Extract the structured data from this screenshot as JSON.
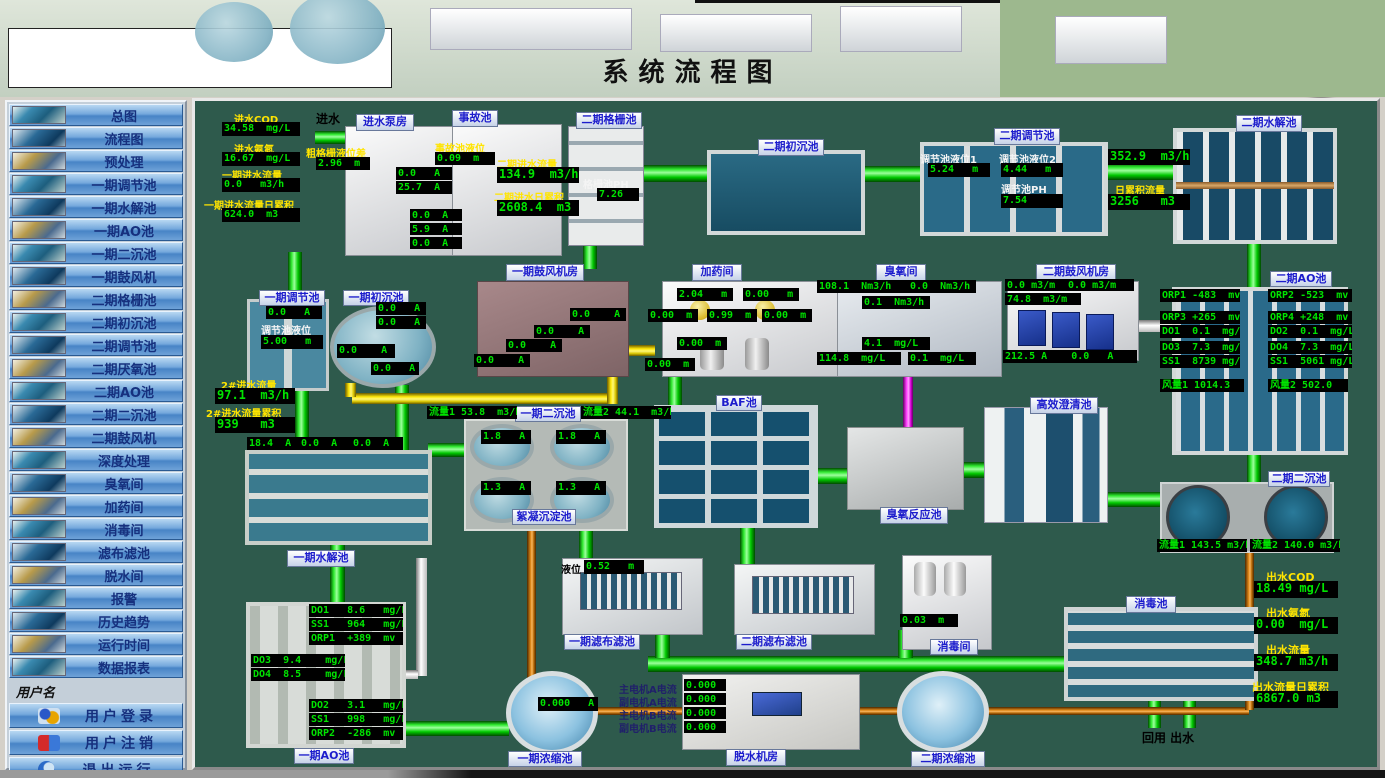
{
  "header": {
    "title": "系统流程图",
    "timestamp": "2017/11/6 9:08:59"
  },
  "sidebar": {
    "items": [
      "总图",
      "流程图",
      "预处理",
      "一期调节池",
      "一期水解池",
      "一期AO池",
      "一期二沉池",
      "一期鼓风机",
      "二期格栅池",
      "二期初沉池",
      "二期调节池",
      "二期厌氧池",
      "二期AO池",
      "二期二沉池",
      "二期鼓风机",
      "深度处理",
      "臭氧间",
      "加药间",
      "消毒间",
      "滤布滤池",
      "脱水间",
      "报警",
      "历史趋势",
      "运行时间",
      "数据报表"
    ],
    "username_label": "用户名",
    "login": "用户登录",
    "logout": "用户注销",
    "exit": "退出运行",
    "company": "山东新日电气设备有限公司"
  },
  "colors": {
    "accent_green": "#00e400",
    "label_yellow": "#ffe400",
    "panel_bg": "#2e5a4c",
    "alarm_red": "#f20000"
  },
  "main": {
    "inlet": {
      "label": "进水",
      "cod_label": "进水COD",
      "cod": "34.58  mg/L",
      "nh3_label": "进水氨氮",
      "nh3": "16.67  mg/L",
      "flow1_label": "一期进水流量",
      "flow1": "0.0   m3/h",
      "total1_label": "一期进水流量日累积",
      "total1": "624.0  m3"
    },
    "pump_house": {
      "label": "进水泵房",
      "screen_label": "粗格栅液位差",
      "screen_level": "2.96  m",
      "c1": "0.0   A",
      "c2": "25.7  A",
      "c3": "0.0  A",
      "c4": "5.9  A",
      "c5": "0.0  A"
    },
    "accident": {
      "label": "事故池",
      "level_label": "事故池液位",
      "level": "0.09  m",
      "flow2_label": "二期进水流量",
      "flow2": "134.9  m3/h",
      "total2_label": "二期进水日累积",
      "total2": "2608.4  m3"
    },
    "grid2": {
      "label": "二期格栅池",
      "ph_label": "格栅池PH",
      "ph": "7.26"
    },
    "primary2": {
      "label": "二期初沉池"
    },
    "reg2": {
      "label": "二期调节池",
      "lv1_label": "调节池液位1",
      "lv1": "5.24   m",
      "lv2_label": "调节池液位2",
      "lv2": "4.44   m",
      "ph_label": "调节池PH",
      "ph": "7.54"
    },
    "hydro2": {
      "label": "二期水解池",
      "flow": "352.9  m3/h",
      "total_label": "日累积流量",
      "total": "3256   m3"
    },
    "reg1": {
      "label": "一期调节池",
      "current": "0.0   A",
      "lv_label": "调节池液位",
      "lv": "5.00   m"
    },
    "primary1": {
      "label": "一期初沉池",
      "c1": "0.0   A",
      "c2": "0.0   A",
      "c3": "0.0    A",
      "c4": "0.0   A"
    },
    "inflow2": {
      "flow_label": "2#进水流量",
      "flow": "97.1  m3/h",
      "total_label": "2#进水流量累积",
      "total": "939   m3",
      "c1": "18.4  A",
      "c2": "0.0  A",
      "c3": "0.0  A"
    },
    "hydro1": {
      "label": "一期水解池"
    },
    "blower1": {
      "label": "一期鼓风机房",
      "c1": "0.0    A",
      "c2": "0.0    A",
      "c3": "0.0    A",
      "c4": "0.0    A"
    },
    "dosing": {
      "label": "加药间",
      "lv1": "2.04   m",
      "lv2": "0.00   m",
      "lv3": "0.00  m",
      "lv4": "0.99  m",
      "lv5": "0.00  m",
      "lv6": "0.00  m",
      "lv7": "0.00  m"
    },
    "ozone": {
      "label": "臭氧间",
      "v1": "108.1  Nm3/h",
      "v2": "0.0  Nm3/h",
      "v3": "0.1  Nm3/h",
      "v4": "4.1  mg/L",
      "v5": "114.8  mg/L",
      "v6": "0.1  mg/L"
    },
    "blower2": {
      "label": "二期鼓风机房",
      "f1": "0.0 m3/m",
      "f2": "0.0 m3/m",
      "f3": "74.8  m3/m",
      "currents": "212.5 A    0.0   A"
    },
    "ao2": {
      "label": "二期AO池",
      "rows_left": [
        "ORP1 -483  mv",
        "ORP3 +265  mv",
        "DO1  0.1  mg/L",
        "DO3  7.3  mg/L",
        "SS1  8739 mg/L",
        "风量1 1014.3"
      ],
      "rows_right": [
        "ORP2 -523  mv",
        "ORP4 +248  mv",
        "DO2  0.1  mg/L",
        "DO4  7.3  mg/L",
        "SS1  5061 mg/L",
        "风量2 502.0"
      ]
    },
    "clar1": {
      "label": "一期二沉池",
      "flow1": "流量1 53.8  m3/h",
      "flow2": "流量2 44.1  m3/h",
      "c1": "1.8   A",
      "c2": "1.8   A",
      "c3": "1.3   A",
      "c4": "1.3   A",
      "floc_label": "絮凝沉淀池"
    },
    "baf": {
      "label": "BAF池"
    },
    "ozone_tank": {
      "label": "臭氧反应池"
    },
    "clarifier_he": {
      "label": "高效澄清池"
    },
    "clar2": {
      "label": "二期二沉池",
      "flow1": "流量1 143.5 m3/h",
      "flow2": "流量2 140.0 m3/h"
    },
    "outlet": {
      "cod_label": "出水COD",
      "cod": "18.49 mg/L",
      "nh3_label": "出水氨氮",
      "nh3": "0.00  mg/L",
      "flow_label": "出水流量",
      "flow": "348.7 m3/h",
      "total_label": "出水流量日累积",
      "total": "6867.0 m3"
    },
    "disinfect_tank": {
      "label": "消毒池"
    },
    "disinfect_room": {
      "label": "消毒间",
      "level": "0.03  m"
    },
    "cloth1": {
      "label": "一期滤布滤池",
      "lv_label": "液位",
      "lv": "0.52   m"
    },
    "cloth2": {
      "label": "二期滤布滤池"
    },
    "thick1": {
      "label": "一期浓缩池",
      "current": "0.000   A"
    },
    "dewater": {
      "label": "脱水机房",
      "l1": "主电机A电流",
      "l2": "副电机A电流",
      "l3": "主电机B电流",
      "l4": "副电机B电流",
      "v1": "0.000",
      "v2": "0.000",
      "v3": "0.000",
      "v4": "0.000"
    },
    "thick2": {
      "label": "二期浓缩池"
    },
    "ao1": {
      "label": "一期AO池",
      "top": [
        "DO1   8.6   mg/L",
        "SS1   964   mg/L",
        "ORP1  +389  mv"
      ],
      "mid": [
        "DO3  9.4    mg/L",
        "DO4  8.5    mg/L"
      ],
      "bottom": [
        "DO2   3.1   mg/L",
        "SS1   998   mg/L",
        "ORP2  -286  mv"
      ]
    },
    "reuse_label": "回用  出水"
  }
}
